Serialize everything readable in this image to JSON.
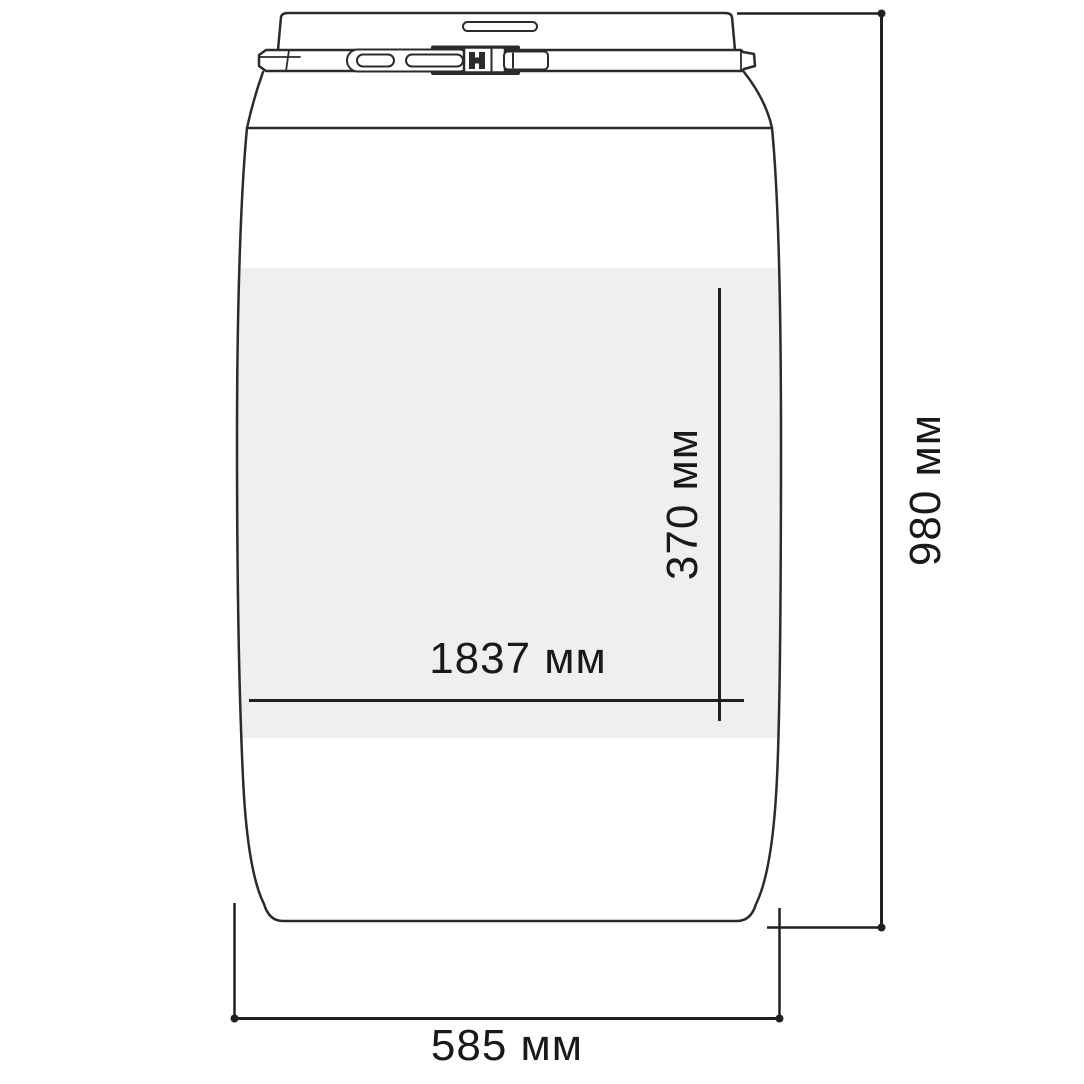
{
  "diagram": {
    "type": "technical-drawing",
    "subject": "barrel-with-clamp-lid-dimensions",
    "labels": {
      "band_length": "1837 мм",
      "band_height": "370 мм",
      "total_height": "980 мм",
      "total_width": "585 мм"
    },
    "colors": {
      "line": "#2b2b2e",
      "dimension_line": "#202023",
      "text": "#19191b",
      "band": "#efeff0",
      "background": "#ffffff",
      "white": "#ffffff"
    }
  }
}
